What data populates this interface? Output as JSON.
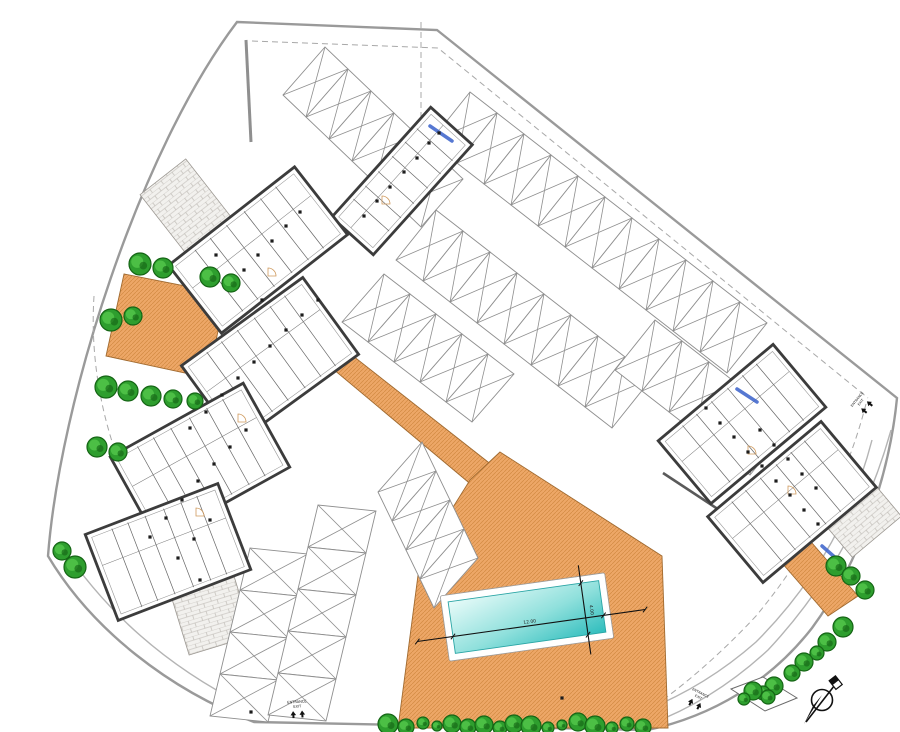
{
  "colors": {
    "boundary": "#9a9a9a",
    "dash": "#a8a8a8",
    "road": "#b4b4b4",
    "stall": "#8f8f8f",
    "wall": "#3c3c3c",
    "orange": "#eda767",
    "orange_hatch": "#d18a42",
    "orange_edge": "#a06a30",
    "pool_light": "#e8fbf9",
    "pool_dark": "#2fbdbd",
    "pool_edge": "#2aa5a5",
    "tree_fill": "#2e9e2e",
    "tree_dark": "#156515",
    "tree_lite": "#4cbf45",
    "paver": "#f2f1ee",
    "paver_line": "#b8b4ae",
    "window_blue": "#3f66cc",
    "fixture": "#1c1c1c"
  },
  "site": {
    "outer": "M237,22 L437,30 L897,398 C890,470 862,560 812,628 C770,682 712,716 648,730 L254,722 C170,690 92,630 48,556 C60,400 140,150 237,22 Z",
    "walls": [
      {
        "d": "M246,40 L251,142",
        "w": 3,
        "c": "#8f8f8f"
      },
      {
        "d": "M663,473 L780,550",
        "w": 2.6,
        "c": "#5a5a5a"
      }
    ],
    "dashed": [
      "M252,41 L438,48 L868,398",
      "M94,296 C86,418 138,550 246,650",
      "M866,404 Q836,520 756,616 Q700,676 640,716",
      "M246,650 Q280,682 294,702",
      "M421,22 L421,145"
    ],
    "roads": [
      "M891,430 Q856,556 768,650 Q714,700 650,724",
      "M872,440 Q842,556 756,642 Q706,686 646,710",
      "M62,546 Q130,648 246,706"
    ]
  },
  "orange_areas": [
    {
      "name": "terrace-left",
      "points": [
        [
          124,
          274
        ],
        [
          226,
          294
        ],
        [
          208,
          378
        ],
        [
          106,
          356
        ]
      ]
    },
    {
      "name": "terrace-path",
      "points": [
        [
          296,
          338
        ],
        [
          320,
          330
        ],
        [
          516,
          484
        ],
        [
          492,
          502
        ]
      ]
    },
    {
      "name": "terrace-pool",
      "points": [
        [
          500,
          452
        ],
        [
          662,
          556
        ],
        [
          668,
          728
        ],
        [
          398,
          728
        ],
        [
          420,
          560
        ],
        [
          470,
          480
        ]
      ]
    },
    {
      "name": "terrace-path-right",
      "points": [
        [
          762,
          540
        ],
        [
          792,
          520
        ],
        [
          858,
          596
        ],
        [
          828,
          616
        ]
      ]
    }
  ],
  "pavers": [
    {
      "cx": 206,
      "cy": 232,
      "w": 58,
      "h": 140,
      "rot": -38
    },
    {
      "cx": 190,
      "cy": 545,
      "w": 66,
      "h": 210,
      "rot": -17
    },
    {
      "cx": 846,
      "cy": 500,
      "w": 64,
      "h": 96,
      "rot": -40
    }
  ],
  "parking_rows": [
    {
      "x": 283,
      "y": 95,
      "ux": 23,
      "uy": 22,
      "vx": 42,
      "vy": -48,
      "n": 6
    },
    {
      "x": 470,
      "y": 92,
      "ux": 27,
      "uy": 21,
      "vx": -40,
      "vy": 50,
      "n": 11
    },
    {
      "x": 436,
      "y": 210,
      "ux": 27,
      "uy": 21,
      "vx": -40,
      "vy": 50,
      "n": 8
    },
    {
      "x": 655,
      "y": 320,
      "ux": 27,
      "uy": 21,
      "vx": -40,
      "vy": 50,
      "n": 5
    },
    {
      "x": 342,
      "y": 322,
      "ux": 26,
      "uy": 20,
      "vx": 42,
      "vy": -48,
      "n": 5
    },
    {
      "x": 378,
      "y": 492,
      "ux": 14,
      "uy": 29,
      "vx": 44,
      "vy": -50,
      "n": 4
    },
    {
      "x": 250,
      "y": 548,
      "ux": -10,
      "uy": 42,
      "vx": 58,
      "vy": 6,
      "n": 4
    },
    {
      "x": 318,
      "y": 505,
      "ux": -10,
      "uy": 42,
      "vx": 58,
      "vy": 6,
      "n": 5
    }
  ],
  "buildings": [
    {
      "name": "building-pool-house",
      "cx": 402,
      "cy": 181,
      "w": 148,
      "h": 56,
      "rot": -48
    },
    {
      "name": "building-left-upper",
      "cx": 258,
      "cy": 250,
      "w": 160,
      "h": 86,
      "rot": -38
    },
    {
      "name": "building-left-a",
      "cx": 270,
      "cy": 360,
      "w": 150,
      "h": 95,
      "rot": -36
    },
    {
      "name": "building-left-b",
      "cx": 200,
      "cy": 462,
      "w": 152,
      "h": 96,
      "rot": -29
    },
    {
      "name": "building-left-c",
      "cx": 168,
      "cy": 552,
      "w": 142,
      "h": 92,
      "rot": -21
    },
    {
      "name": "building-right-a",
      "cx": 742,
      "cy": 424,
      "w": 150,
      "h": 82,
      "rot": -40
    },
    {
      "name": "building-right-b",
      "cx": 792,
      "cy": 502,
      "w": 148,
      "h": 86,
      "rot": -40
    }
  ],
  "blue_windows": [
    [
      430,
      126,
      452,
      141
    ],
    [
      737,
      389,
      757,
      402
    ],
    [
      822,
      546,
      838,
      560
    ]
  ],
  "door_arcs": [
    [
      382,
      196
    ],
    [
      268,
      268
    ],
    [
      238,
      414
    ],
    [
      196,
      508
    ],
    [
      748,
      446
    ],
    [
      788,
      486
    ]
  ],
  "fixtures": [
    [
      429,
      143
    ],
    [
      417,
      158
    ],
    [
      404,
      172
    ],
    [
      390,
      187
    ],
    [
      377,
      201
    ],
    [
      364,
      216
    ],
    [
      439,
      133
    ],
    [
      300,
      212
    ],
    [
      286,
      226
    ],
    [
      272,
      241
    ],
    [
      258,
      255
    ],
    [
      244,
      270
    ],
    [
      230,
      284
    ],
    [
      216,
      255
    ],
    [
      318,
      300
    ],
    [
      302,
      315
    ],
    [
      286,
      330
    ],
    [
      270,
      346
    ],
    [
      254,
      362
    ],
    [
      238,
      378
    ],
    [
      262,
      300
    ],
    [
      222,
      395
    ],
    [
      206,
      412
    ],
    [
      190,
      428
    ],
    [
      246,
      430
    ],
    [
      230,
      447
    ],
    [
      214,
      464
    ],
    [
      198,
      481
    ],
    [
      182,
      500
    ],
    [
      166,
      518
    ],
    [
      150,
      537
    ],
    [
      210,
      520
    ],
    [
      194,
      539
    ],
    [
      178,
      558
    ],
    [
      200,
      580
    ],
    [
      706,
      408
    ],
    [
      720,
      423
    ],
    [
      734,
      437
    ],
    [
      748,
      452
    ],
    [
      762,
      466
    ],
    [
      776,
      481
    ],
    [
      790,
      495
    ],
    [
      804,
      510
    ],
    [
      818,
      524
    ],
    [
      760,
      430
    ],
    [
      774,
      445
    ],
    [
      788,
      459
    ],
    [
      802,
      474
    ],
    [
      816,
      488
    ],
    [
      251,
      712
    ],
    [
      562,
      698
    ]
  ],
  "planter": {
    "points": [
      [
        731,
        689
      ],
      [
        763,
        677
      ],
      [
        797,
        698
      ],
      [
        765,
        711
      ]
    ]
  },
  "trees": [
    [
      140,
      264,
      11
    ],
    [
      163,
      268,
      10
    ],
    [
      210,
      277,
      10
    ],
    [
      231,
      283,
      9
    ],
    [
      111,
      320,
      11
    ],
    [
      133,
      316,
      9
    ],
    [
      106,
      387,
      11
    ],
    [
      128,
      391,
      10
    ],
    [
      151,
      396,
      10
    ],
    [
      173,
      399,
      9
    ],
    [
      195,
      401,
      8
    ],
    [
      97,
      447,
      10
    ],
    [
      118,
      452,
      9
    ],
    [
      62,
      551,
      9
    ],
    [
      75,
      567,
      11
    ],
    [
      388,
      724,
      10
    ],
    [
      406,
      727,
      8
    ],
    [
      423,
      723,
      6
    ],
    [
      437,
      726,
      5
    ],
    [
      452,
      724,
      9
    ],
    [
      468,
      727,
      8
    ],
    [
      484,
      725,
      9
    ],
    [
      500,
      728,
      7
    ],
    [
      514,
      724,
      9
    ],
    [
      531,
      726,
      10
    ],
    [
      548,
      728,
      6
    ],
    [
      562,
      725,
      5
    ],
    [
      578,
      722,
      9
    ],
    [
      595,
      726,
      10
    ],
    [
      612,
      728,
      6
    ],
    [
      627,
      724,
      7
    ],
    [
      643,
      727,
      8
    ],
    [
      836,
      566,
      10
    ],
    [
      851,
      576,
      9
    ],
    [
      865,
      590,
      9
    ],
    [
      843,
      627,
      10
    ],
    [
      827,
      642,
      9
    ],
    [
      817,
      653,
      7
    ],
    [
      804,
      662,
      9
    ],
    [
      792,
      673,
      8
    ],
    [
      774,
      686,
      9
    ],
    [
      763,
      693,
      7
    ],
    [
      753,
      691,
      9
    ],
    [
      768,
      697,
      7
    ],
    [
      744,
      699,
      6
    ]
  ],
  "pool": {
    "cx": 527,
    "cy": 617,
    "rot": -8,
    "ow": 166,
    "oh": 66,
    "iw": 152,
    "ih": 52,
    "length_label": "12.00",
    "width_label": "4.00"
  },
  "labels": [
    {
      "name": "entrance-label-bottom",
      "x": 297,
      "y": 703,
      "rot": -4,
      "size": 3.6,
      "arrows": true,
      "lines": [
        "ENTRANCE",
        "EXIT"
      ]
    },
    {
      "name": "entrance-label-bottom-right",
      "x": 700,
      "y": 694,
      "rot": 27,
      "size": 3.4,
      "arrows": true,
      "lines": [
        "ENTRANCE",
        "EXIT"
      ]
    },
    {
      "name": "entrance-label-right",
      "x": 858,
      "y": 400,
      "rot": -51,
      "size": 3.4,
      "arrows": true,
      "lines": [
        "ENTRANCE",
        "EXIT"
      ]
    }
  ],
  "compass": {
    "cx": 822,
    "cy": 700
  }
}
